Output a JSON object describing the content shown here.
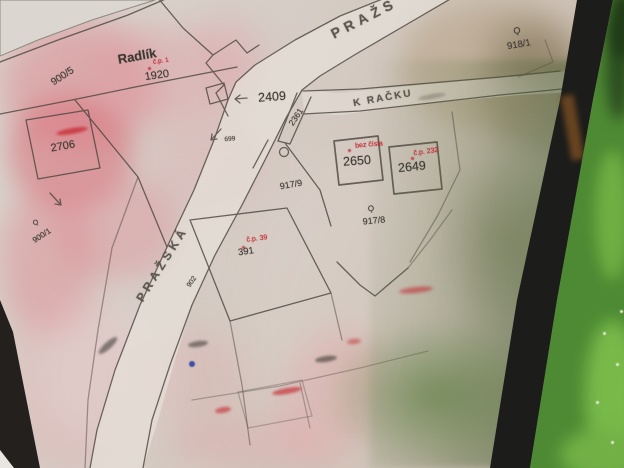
{
  "scene": {
    "type": "photograph-of-cadastral-map",
    "place_name": "Radlík"
  },
  "map": {
    "street_labels": [
      {
        "name": "street-label-prazska-top",
        "text": "PRAŽS",
        "x": 364,
        "y": 18,
        "rot": -27,
        "fs": 14,
        "ls": 5
      },
      {
        "name": "street-label-k-racku",
        "text": "K RAČKU",
        "x": 383,
        "y": 99,
        "rot": -10,
        "fs": 10,
        "ls": 2
      },
      {
        "name": "street-label-prazska",
        "text": "PRAŽSKÁ",
        "x": 162,
        "y": 264,
        "rot": -58,
        "fs": 12,
        "ls": 4
      }
    ],
    "black_labels": [
      {
        "name": "place-label-radlik",
        "text": "Radlík",
        "x": 137,
        "y": 56,
        "rot": -10,
        "fs": 13,
        "bold": true
      },
      {
        "name": "parcel-label-1920",
        "text": "1920",
        "x": 157,
        "y": 76,
        "rot": -8,
        "fs": 11
      },
      {
        "name": "parcel-label-900-5",
        "text": "900/5",
        "x": 63,
        "y": 77,
        "rot": -33,
        "fs": 10
      },
      {
        "name": "parcel-label-2706",
        "text": "2706",
        "x": 63,
        "y": 147,
        "rot": -10,
        "fs": 11
      },
      {
        "name": "parcel-label-900-1",
        "text": "900/1",
        "x": 42,
        "y": 236,
        "rot": -33,
        "fs": 8
      },
      {
        "name": "parcel-label-2409",
        "text": "2409",
        "x": 272,
        "y": 97,
        "rot": -4,
        "fs": 12.5
      },
      {
        "name": "parcel-label-699",
        "text": "699",
        "x": 230,
        "y": 140,
        "rot": -5,
        "fs": 6.5
      },
      {
        "name": "parcel-label-2361",
        "text": "2361",
        "x": 296,
        "y": 117,
        "rot": -56,
        "fs": 8.5
      },
      {
        "name": "parcel-label-902",
        "text": "902",
        "x": 192,
        "y": 282,
        "rot": -56,
        "fs": 7
      },
      {
        "name": "parcel-label-918-1",
        "text": "918/1",
        "x": 519,
        "y": 45,
        "rot": -10,
        "fs": 9.5
      },
      {
        "name": "parcel-label-2650",
        "text": "2650",
        "x": 357,
        "y": 161,
        "rot": -4,
        "fs": 12.5
      },
      {
        "name": "parcel-label-2649",
        "text": "2649",
        "x": 412,
        "y": 167,
        "rot": -6,
        "fs": 12.5
      },
      {
        "name": "parcel-label-917-9",
        "text": "917/9",
        "x": 291,
        "y": 185,
        "rot": -10,
        "fs": 9
      },
      {
        "name": "parcel-label-917-8",
        "text": "917/8",
        "x": 374,
        "y": 221,
        "rot": -6,
        "fs": 9
      },
      {
        "name": "parcel-label-391",
        "text": "391",
        "x": 246,
        "y": 252,
        "rot": -8,
        "fs": 9.5
      },
      {
        "name": "landuse-symbol-918",
        "text": "Ǫ",
        "x": 517,
        "y": 31,
        "rot": -10,
        "fs": 9
      },
      {
        "name": "landuse-symbol-917",
        "text": "Ǫ",
        "x": 371,
        "y": 209,
        "rot": -6,
        "fs": 8
      },
      {
        "name": "landuse-symbol-900",
        "text": "Ǫ",
        "x": 36,
        "y": 223,
        "rot": -33,
        "fs": 7
      }
    ],
    "red_labels": [
      {
        "name": "house-number-cp1",
        "text": "č.p. 1",
        "x": 161,
        "y": 62,
        "rot": -8,
        "fs": 6.5
      },
      {
        "name": "house-number-bez-cisla",
        "text": "bez čísla",
        "x": 369,
        "y": 145,
        "rot": -5,
        "fs": 7
      },
      {
        "name": "house-number-cp232",
        "text": "č.p. 232",
        "x": 426,
        "y": 152,
        "rot": -8,
        "fs": 7
      },
      {
        "name": "house-number-cp39",
        "text": "č.p. 39",
        "x": 257,
        "y": 239,
        "rot": -7,
        "fs": 7
      }
    ],
    "marks": [
      {
        "name": "red-mark-illegible-2706",
        "x": 72,
        "y": 131,
        "w": 32,
        "h": 6,
        "rot": -10,
        "color": "rgba(200,40,48,0.75)",
        "blur": 1.2
      },
      {
        "name": "red-mark-illegible-1",
        "x": 416,
        "y": 290,
        "w": 34,
        "h": 6,
        "rot": -6,
        "color": "rgba(190,45,50,0.6)",
        "blur": 1.5
      },
      {
        "name": "red-mark-illegible-2",
        "x": 354,
        "y": 341,
        "w": 14,
        "h": 5,
        "rot": -6,
        "color": "rgba(190,45,50,0.55)",
        "blur": 1.5
      },
      {
        "name": "red-mark-illegible-3",
        "x": 287,
        "y": 391,
        "w": 30,
        "h": 6,
        "rot": -10,
        "color": "rgba(195,40,48,0.65)",
        "blur": 1.4
      },
      {
        "name": "red-mark-illegible-4",
        "x": 223,
        "y": 410,
        "w": 16,
        "h": 6,
        "rot": -10,
        "color": "rgba(195,40,48,0.6)",
        "blur": 1.4
      },
      {
        "name": "red-dot-1",
        "x": 149,
        "y": 68,
        "w": 3,
        "h": 3,
        "rot": 0,
        "color": "rgba(196,35,43,0.85)",
        "blur": 0.4
      },
      {
        "name": "red-dot-2",
        "x": 349,
        "y": 150,
        "w": 3,
        "h": 3,
        "rot": 0,
        "color": "rgba(196,35,43,0.85)",
        "blur": 0.4
      },
      {
        "name": "red-dot-3",
        "x": 412,
        "y": 158,
        "w": 3,
        "h": 3,
        "rot": 0,
        "color": "rgba(196,35,43,0.85)",
        "blur": 0.4
      },
      {
        "name": "red-dot-4",
        "x": 243,
        "y": 247,
        "w": 3,
        "h": 3,
        "rot": 0,
        "color": "rgba(196,35,43,0.85)",
        "blur": 0.4
      },
      {
        "name": "text-mark-illegible-1",
        "x": 326,
        "y": 359,
        "w": 22,
        "h": 6,
        "rot": -8,
        "color": "rgba(70,64,58,0.65)",
        "blur": 1.2
      },
      {
        "name": "text-mark-illegible-2",
        "x": 108,
        "y": 345,
        "w": 24,
        "h": 7,
        "rot": -42,
        "color": "rgba(70,64,58,0.6)",
        "blur": 1.3
      },
      {
        "name": "text-mark-illegible-3",
        "x": 198,
        "y": 344,
        "w": 20,
        "h": 6,
        "rot": -8,
        "color": "rgba(70,64,58,0.6)",
        "blur": 1.3
      },
      {
        "name": "text-mark-k-racku-faint",
        "x": 432,
        "y": 96,
        "w": 28,
        "h": 5,
        "rot": -10,
        "color": "rgba(125,118,106,0.55)",
        "blur": 1.2
      },
      {
        "name": "blue-survey-dot",
        "x": 192,
        "y": 364,
        "w": 6,
        "h": 6,
        "rot": 0,
        "color": "#3b4fa8",
        "blur": 0.5
      }
    ]
  }
}
